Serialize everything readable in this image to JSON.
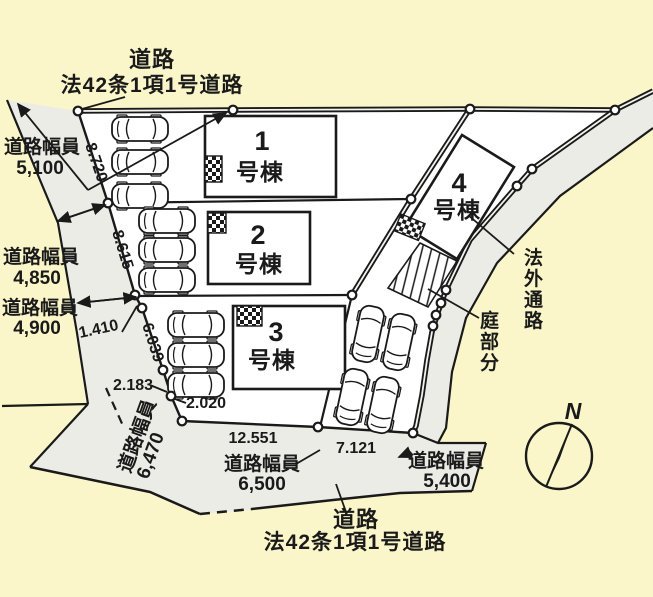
{
  "title": "区画図",
  "colors": {
    "background": "#FAF6C9",
    "road": "#ECECE7",
    "site": "#FFFFFF",
    "line": "#1A1A1A"
  },
  "roads": {
    "top": {
      "name_line1": "道路",
      "name_line2": "法42条1項1号道路"
    },
    "bottom": {
      "name_line1": "道路",
      "name_line2": "法42条1項1号道路"
    },
    "side_path": "法外通路",
    "widths": {
      "left_top": {
        "label": "道路幅員",
        "value": "5,100"
      },
      "left_mid": {
        "label": "道路幅員",
        "value": "4,850"
      },
      "left_low": {
        "label": "道路幅員",
        "value": "4,900"
      },
      "bottom_left": {
        "label": "道路幅員",
        "value": "6,470"
      },
      "bottom_center": {
        "label": "道路幅員",
        "value": "6,500"
      },
      "bottom_right": {
        "label": "道路幅員",
        "value": "5,400"
      }
    }
  },
  "buildings": [
    {
      "number": "1",
      "suffix": "号棟"
    },
    {
      "number": "2",
      "suffix": "号棟"
    },
    {
      "number": "3",
      "suffix": "号棟"
    },
    {
      "number": "4",
      "suffix": "号棟"
    }
  ],
  "garden_label": "庭部分",
  "dimensions": {
    "d8720": "8.720",
    "d8615": "8.615",
    "d1410": "1.410",
    "d6039": "6.039",
    "d2183": "2.183",
    "d2020": "2.020",
    "d12551": "12.551",
    "d7121": "7.121"
  },
  "compass": {
    "north_label": "N"
  }
}
